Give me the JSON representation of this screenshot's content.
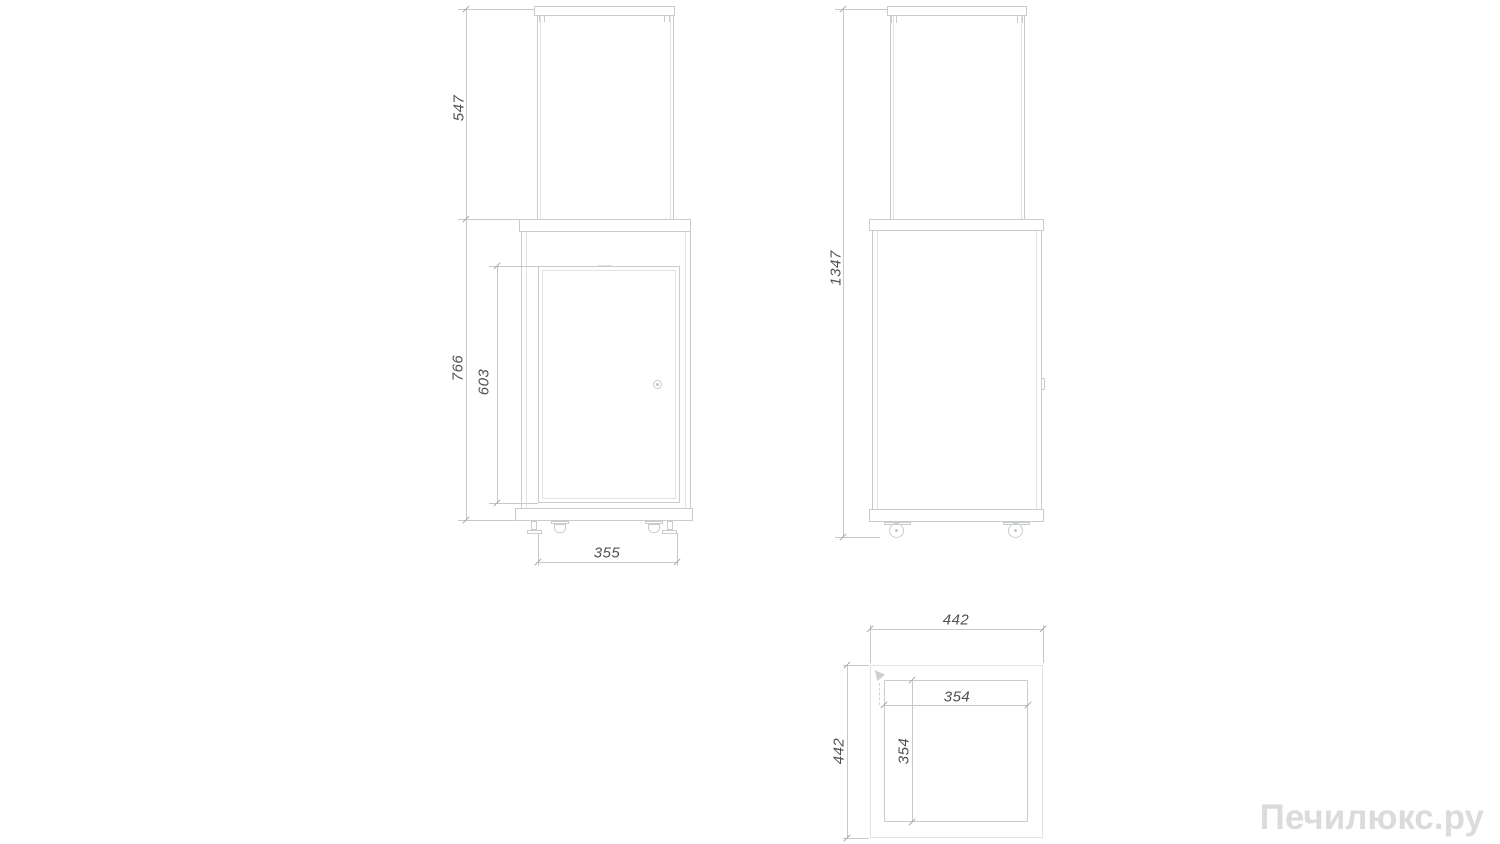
{
  "drawing": {
    "type": "technical-dimension-drawing",
    "views": {
      "front": {
        "label": "front view",
        "dims": {
          "glass_section_height": "547",
          "body_section_height": "766",
          "door_height": "603",
          "base_width": "355"
        }
      },
      "side": {
        "label": "side view",
        "dims": {
          "total_height": "1347"
        }
      },
      "top": {
        "label": "top view",
        "dims": {
          "outer_width": "442",
          "outer_depth": "442",
          "inner_width": "354",
          "inner_depth": "354"
        }
      }
    },
    "colors": {
      "object_line": "#c9cccd",
      "dimension_line": "#c6c9ca",
      "tick": "#9fa3a4",
      "dimension_text": "#4f5254",
      "watermark": "#dbdbdb",
      "background": "#ffffff"
    }
  },
  "watermark": {
    "text": "Печилюкс.ру"
  }
}
